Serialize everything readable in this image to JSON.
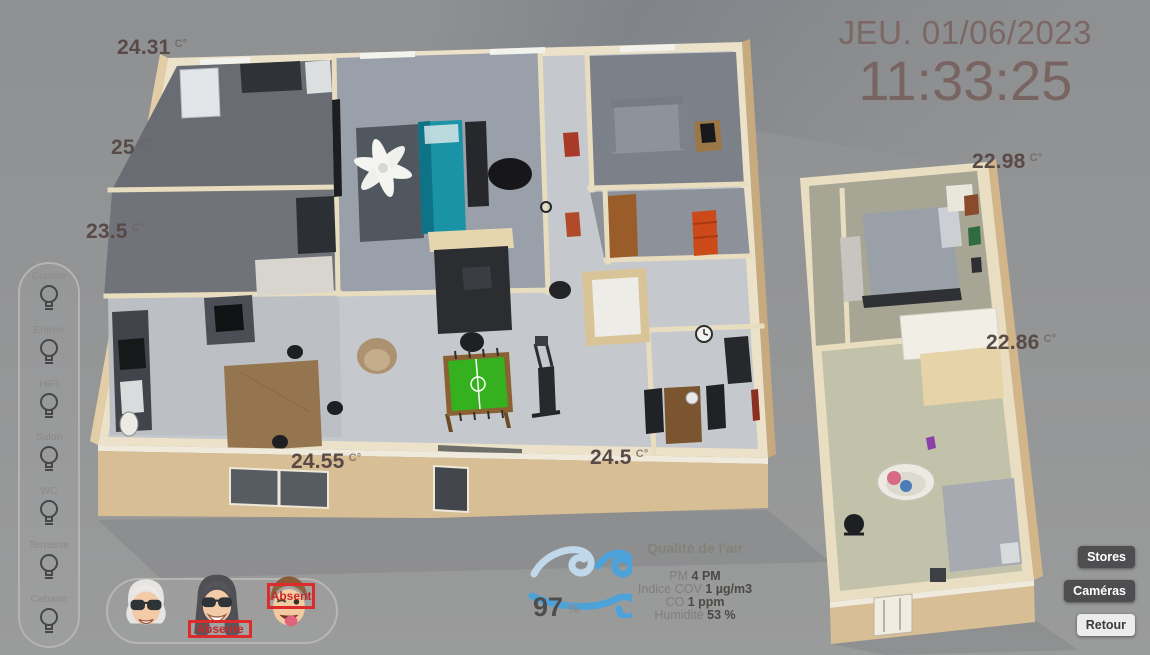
{
  "clock": {
    "date": "JEU. 01/06/2023",
    "time": "11:33:25"
  },
  "temperatures": [
    {
      "value": "24.31",
      "unit": "C°"
    },
    {
      "value": "25",
      "unit": "C°"
    },
    {
      "value": "23.5",
      "unit": "C°"
    },
    {
      "value": "24.55",
      "unit": "C°"
    },
    {
      "value": "24.5",
      "unit": "C°"
    },
    {
      "value": "22.98",
      "unit": "C°"
    },
    {
      "value": "22.86",
      "unit": "C°"
    }
  ],
  "lights": {
    "items": [
      {
        "label": "Cuisine"
      },
      {
        "label": "Entrée"
      },
      {
        "label": "HIFI"
      },
      {
        "label": "Salon"
      },
      {
        "label": "WC"
      },
      {
        "label": "Terrasse"
      },
      {
        "label": "Cabane"
      }
    ]
  },
  "presence": {
    "avatars": [
      {
        "name": "grandma",
        "status": ""
      },
      {
        "name": "woman",
        "status": "Absente"
      },
      {
        "name": "boy",
        "status": "Absent"
      }
    ]
  },
  "air_quality": {
    "wind_value": "97",
    "wind_unit": "%",
    "title": "Qualité de l'air",
    "metrics": [
      {
        "label": "PM",
        "value": "4 PM"
      },
      {
        "label": "Indice COV",
        "value": "1 µg/m3"
      },
      {
        "label": "CO",
        "value": "1 ppm"
      },
      {
        "label": "Humidité",
        "value": "53 %"
      }
    ]
  },
  "buttons": [
    {
      "label": "Stores"
    },
    {
      "label": "Caméras"
    },
    {
      "label": "Retour"
    }
  ],
  "colors": {
    "accent_red": "#d32f2f",
    "wind_blue": "#4da3d9",
    "wind_blue_light": "#c0d8ea",
    "button_dark": "#4e4e50",
    "temp_text": "#594a48",
    "clock_text": "#7b6764",
    "wall_tan": "#d8be94",
    "floor_gray": "#c5c8cc"
  }
}
